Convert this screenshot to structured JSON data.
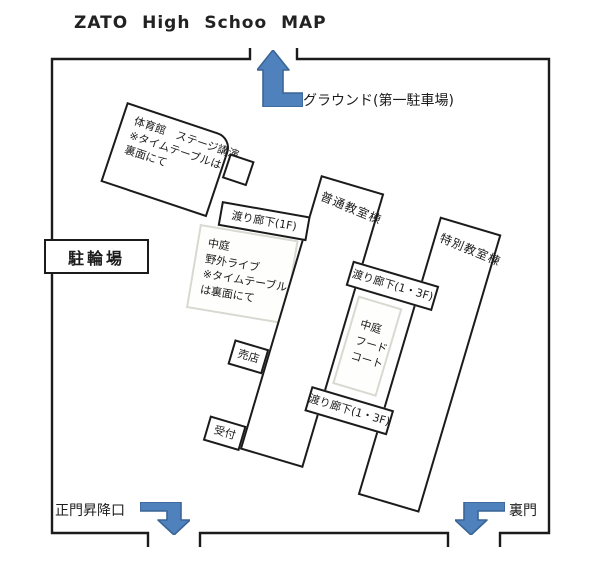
{
  "title": "ZATO High Schoo MAP",
  "colors": {
    "arrow_fill": "#4f81bd",
    "arrow_stroke": "#3a6596",
    "wall": "#1b1b1b",
    "courtyard_border": "#d9d9d2"
  },
  "map": {
    "buildings": {
      "gym": {
        "line1": "体育館　ステージ講演",
        "line2": "※タイムテーブルは",
        "line3": "裏面にて"
      },
      "regular_classroom": {
        "label": "普通教室棟"
      },
      "special_classroom": {
        "label": "特別教室棟"
      },
      "bike_parking": {
        "label": "駐輪場"
      },
      "shop": {
        "label": "売店"
      },
      "reception": {
        "label": "受付"
      }
    },
    "corridors": {
      "corridor_1f": {
        "label": "渡り廊下(1F)"
      },
      "corridor_13f_upper": {
        "label": "渡り廊下(1・3F)"
      },
      "corridor_13f_lower": {
        "label": "渡り廊下(1・3F)"
      }
    },
    "courtyards": {
      "outdoor_live": {
        "line1": "中庭",
        "line2": "野外ライブ",
        "line3": "※タイムテーブル",
        "line4": "は裏面にて"
      },
      "food_court": {
        "line1": "中庭",
        "line2": "フード",
        "line3": "コート"
      }
    },
    "gates": {
      "ground": {
        "label": "グラウンド(第一駐車場)"
      },
      "main_gate": {
        "label": "正門昇降口"
      },
      "back_gate": {
        "label": "裏門"
      }
    }
  }
}
